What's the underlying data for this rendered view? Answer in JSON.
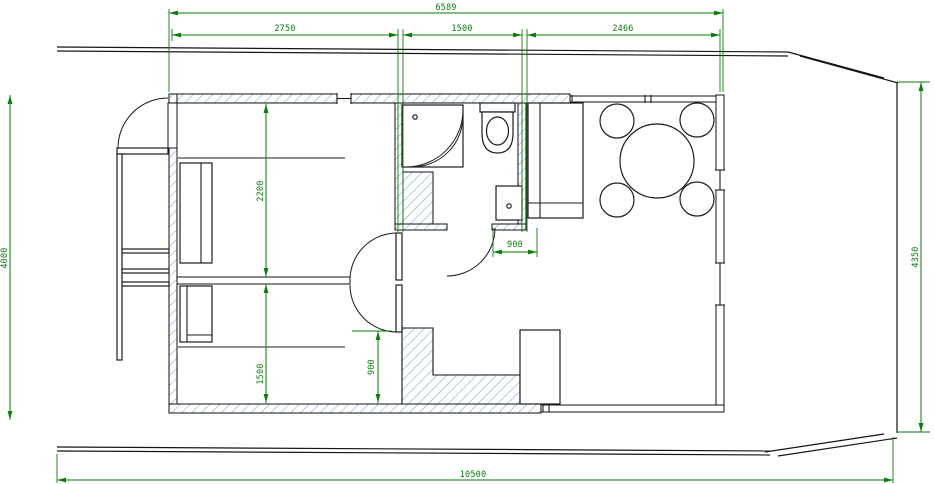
{
  "drawing": {
    "type": "houseboat-floor-plan",
    "units": "mm",
    "colors": {
      "dimension_green": "#0b7d0b",
      "wall_black": "#111111",
      "hatch_blue": "#8fb0d8",
      "background": "#ffffff"
    },
    "dimensions": {
      "overall_width_top": "6589",
      "section_left_width": "2750",
      "section_middle_width": "1500",
      "section_right_width": "2466",
      "height_left": "4000",
      "height_right": "4350",
      "overall_length_bottom": "10500",
      "bedroom_upper_depth": "2200",
      "bedroom_lower_depth": "1500",
      "bathroom_width": "900",
      "kitchen_depth": "900"
    }
  }
}
